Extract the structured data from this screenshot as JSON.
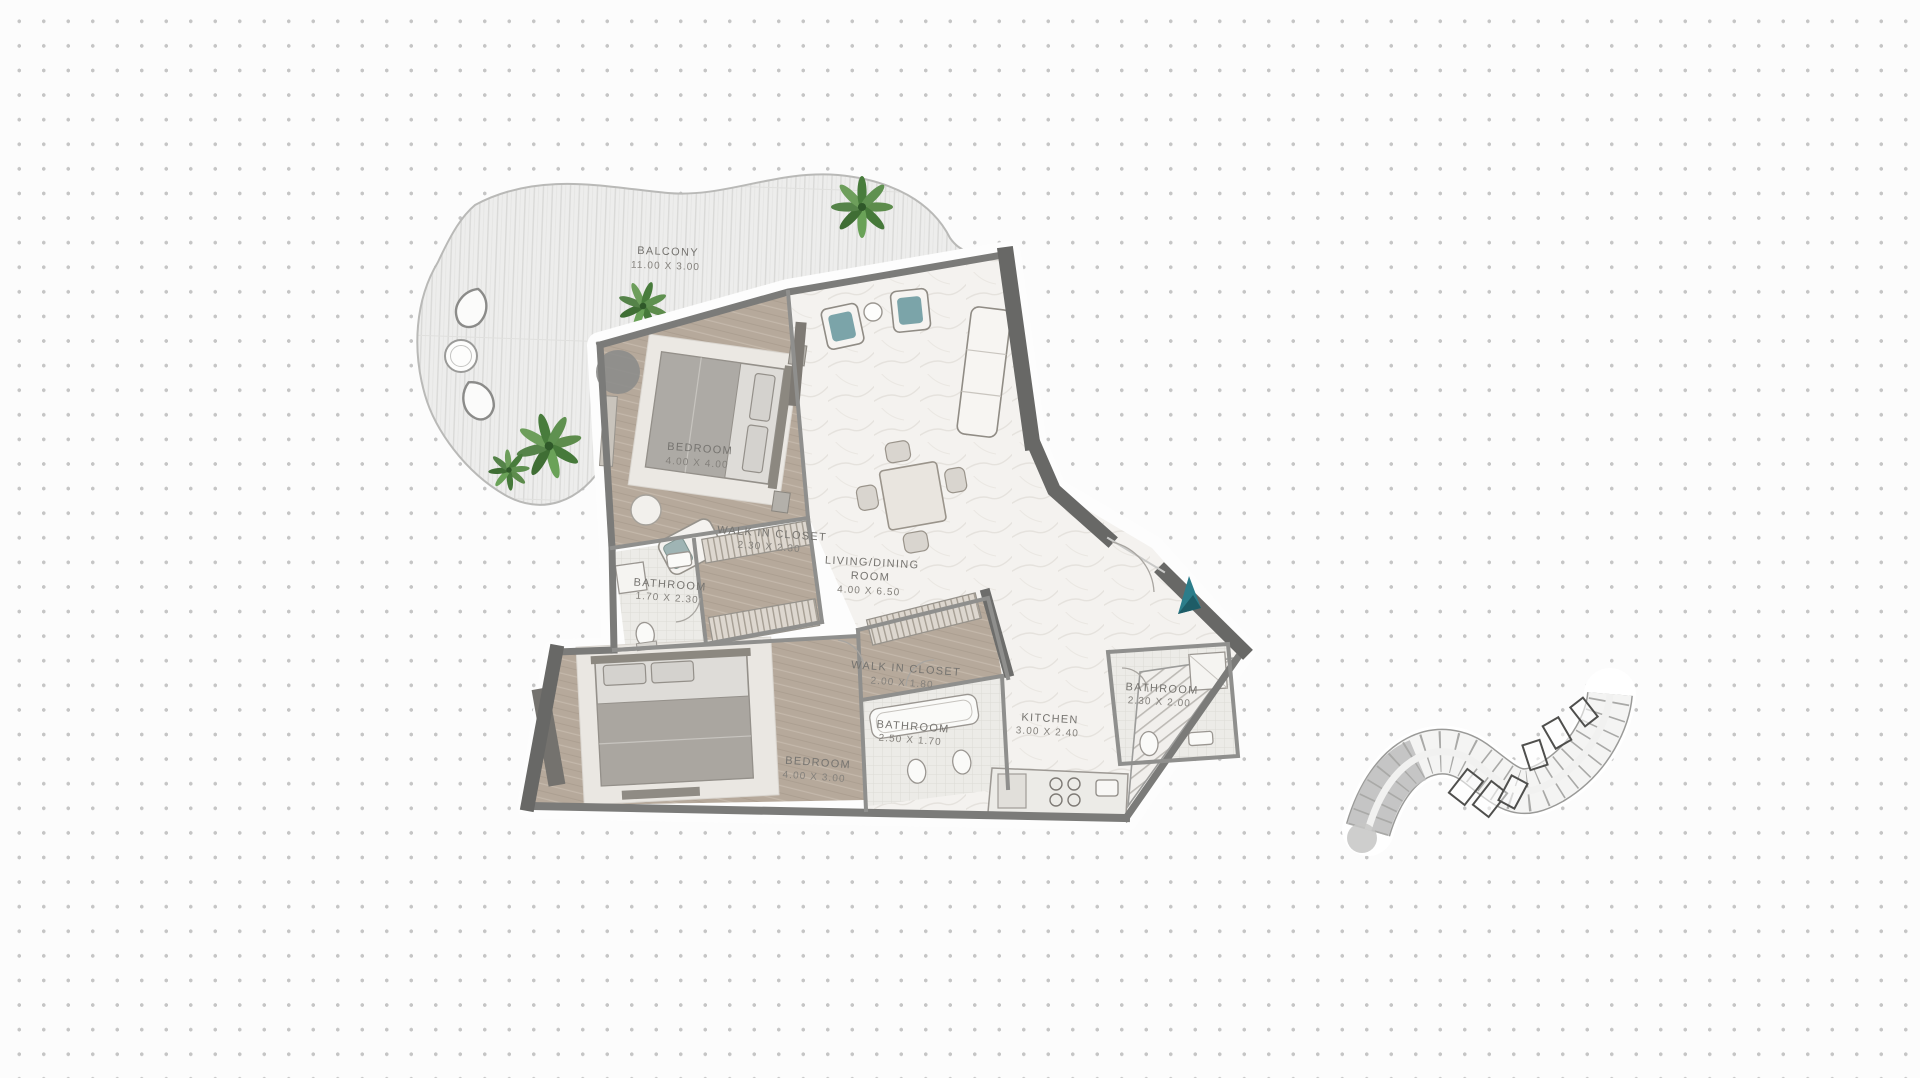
{
  "plan": {
    "balcony": {
      "name": "BALCONY",
      "dims": "11.00 X 3.00"
    },
    "bedroom1": {
      "name": "BEDROOM",
      "dims": "4.00 X 4.00"
    },
    "walk_in_closet1": {
      "name": "WALK IN CLOSET",
      "dims": "2.30 X 2.30"
    },
    "bathroom1": {
      "name": "BATHROOM",
      "dims": "1.70 X 2.30"
    },
    "living": {
      "name": "LIVING/DINING",
      "name2": "ROOM",
      "dims": "4.00 X 6.50"
    },
    "walk_in_closet2": {
      "name": "WALK IN CLOSET",
      "dims": "2.00 X 1.80"
    },
    "bedroom2": {
      "name": "BEDROOM",
      "dims": "4.00 X 3.00"
    },
    "bathroom2": {
      "name": "BATHROOM",
      "dims": "2.50 X 1.70"
    },
    "kitchen": {
      "name": "KITCHEN",
      "dims": "3.00 X 2.40"
    },
    "bathroom3": {
      "name": "BATHROOM",
      "dims": "2.30 X 2.00"
    },
    "colors": {
      "entrance_arrow": "#2c7d8a",
      "entrance_arrow_dark": "#1e5c66",
      "bedroom_floor": "#b7aa9c",
      "wall": "#7d7d7d",
      "keyplan_highlight": "#c0c0c0"
    }
  }
}
